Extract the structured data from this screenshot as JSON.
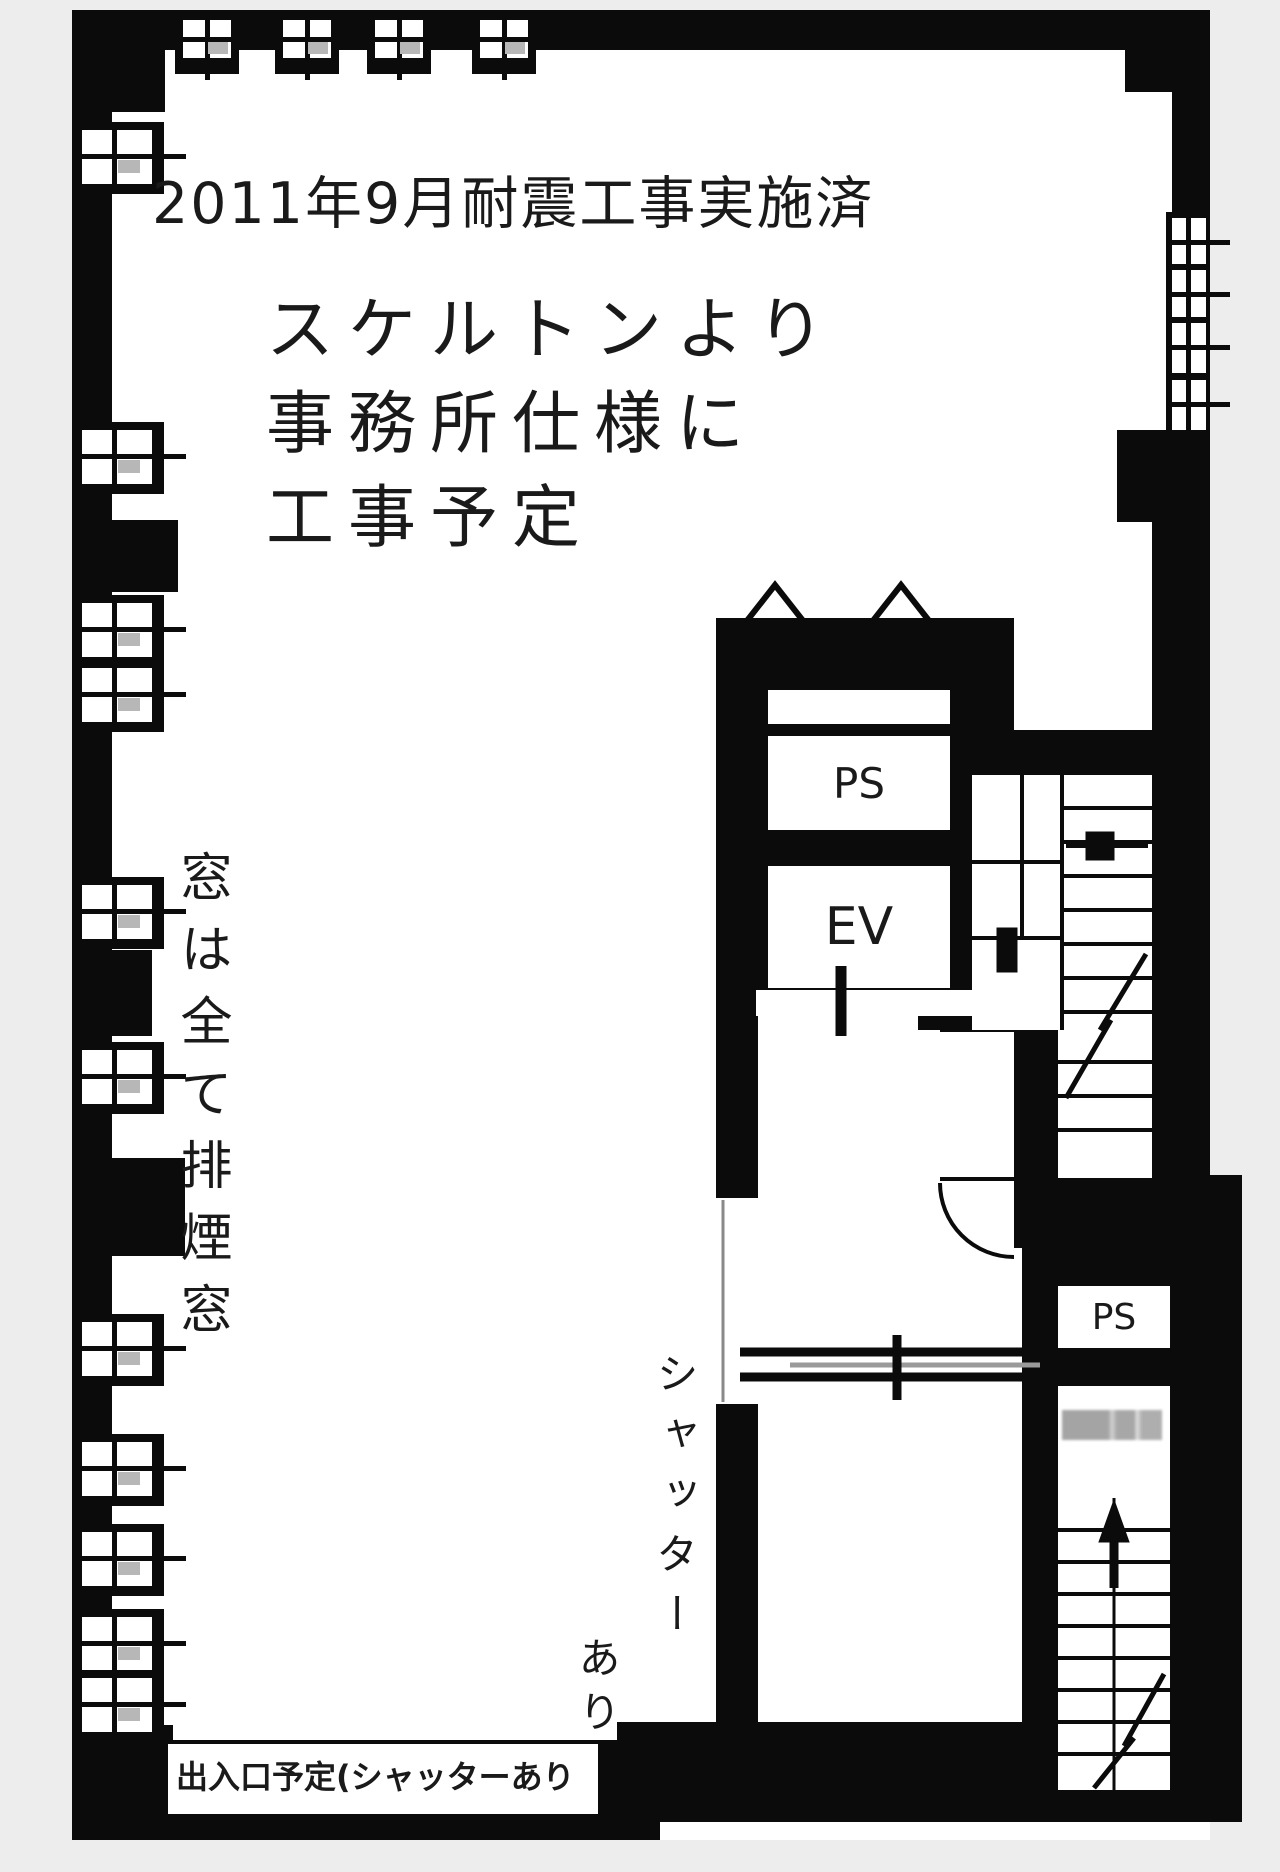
{
  "colors": {
    "wall": "#0b0b0b",
    "floor": "#ffffff",
    "background": "#ededed",
    "ink": "#1a1a1a",
    "shutter_line": "#8a8a8a"
  },
  "annotations": {
    "seismic_note": "2011年9月耐震工事実施済",
    "plan_lines": [
      "スケルトンより",
      "事務所仕様に",
      "工事予定"
    ],
    "window_note": "窓は全て排煙窓",
    "shutter_note_col1": "シャッター",
    "shutter_note_col2": "あり",
    "entrance_note": "出入口予定(シャッターあり"
  },
  "rooms": {
    "pipe_space_upper": "PS",
    "elevator": "EV",
    "pipe_space_lower": "PS"
  }
}
